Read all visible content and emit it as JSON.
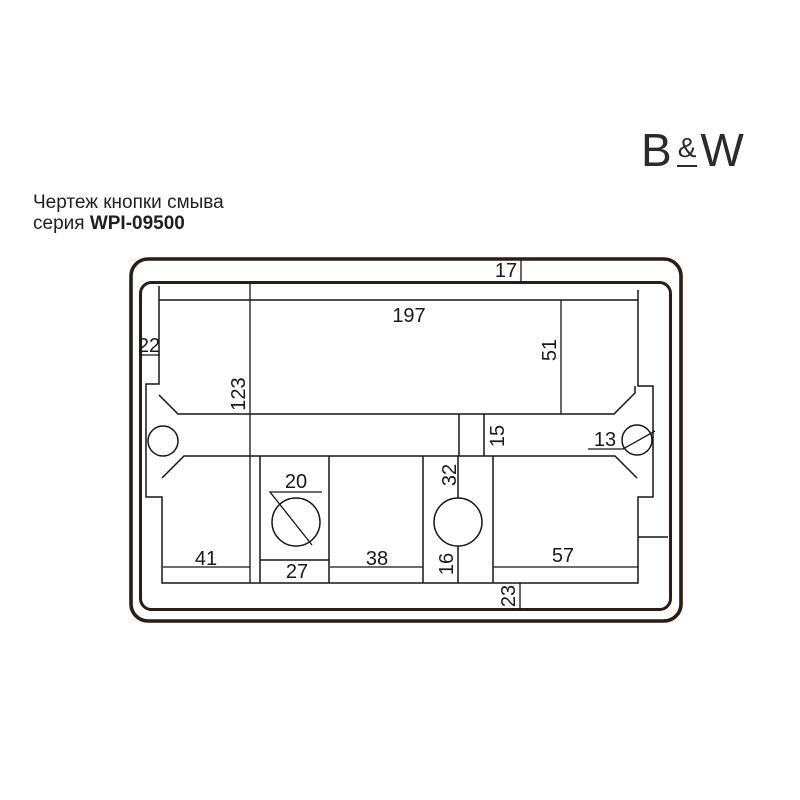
{
  "header": {
    "title": "Чертеж кнопки смыва",
    "series_prefix": "серия ",
    "series_code": "WPI-09500"
  },
  "logo": {
    "letter_b": "B",
    "ampersand": "&",
    "letter_w": "W"
  },
  "drawing": {
    "description": "Flush button technical drawing, back view with mounting frame",
    "colors": {
      "plate_outline": "#2a1d16",
      "thin_line": "#161616",
      "background": "#ffffff"
    },
    "dims": {
      "v17": "17",
      "v197": "197",
      "v22": "22",
      "v51": "51",
      "v123": "123",
      "v15": "15",
      "v13": "13",
      "v20": "20",
      "v32": "32",
      "v41": "41",
      "v27": "27",
      "v38": "38",
      "v16": "16",
      "v57": "57",
      "v23": "23"
    }
  }
}
